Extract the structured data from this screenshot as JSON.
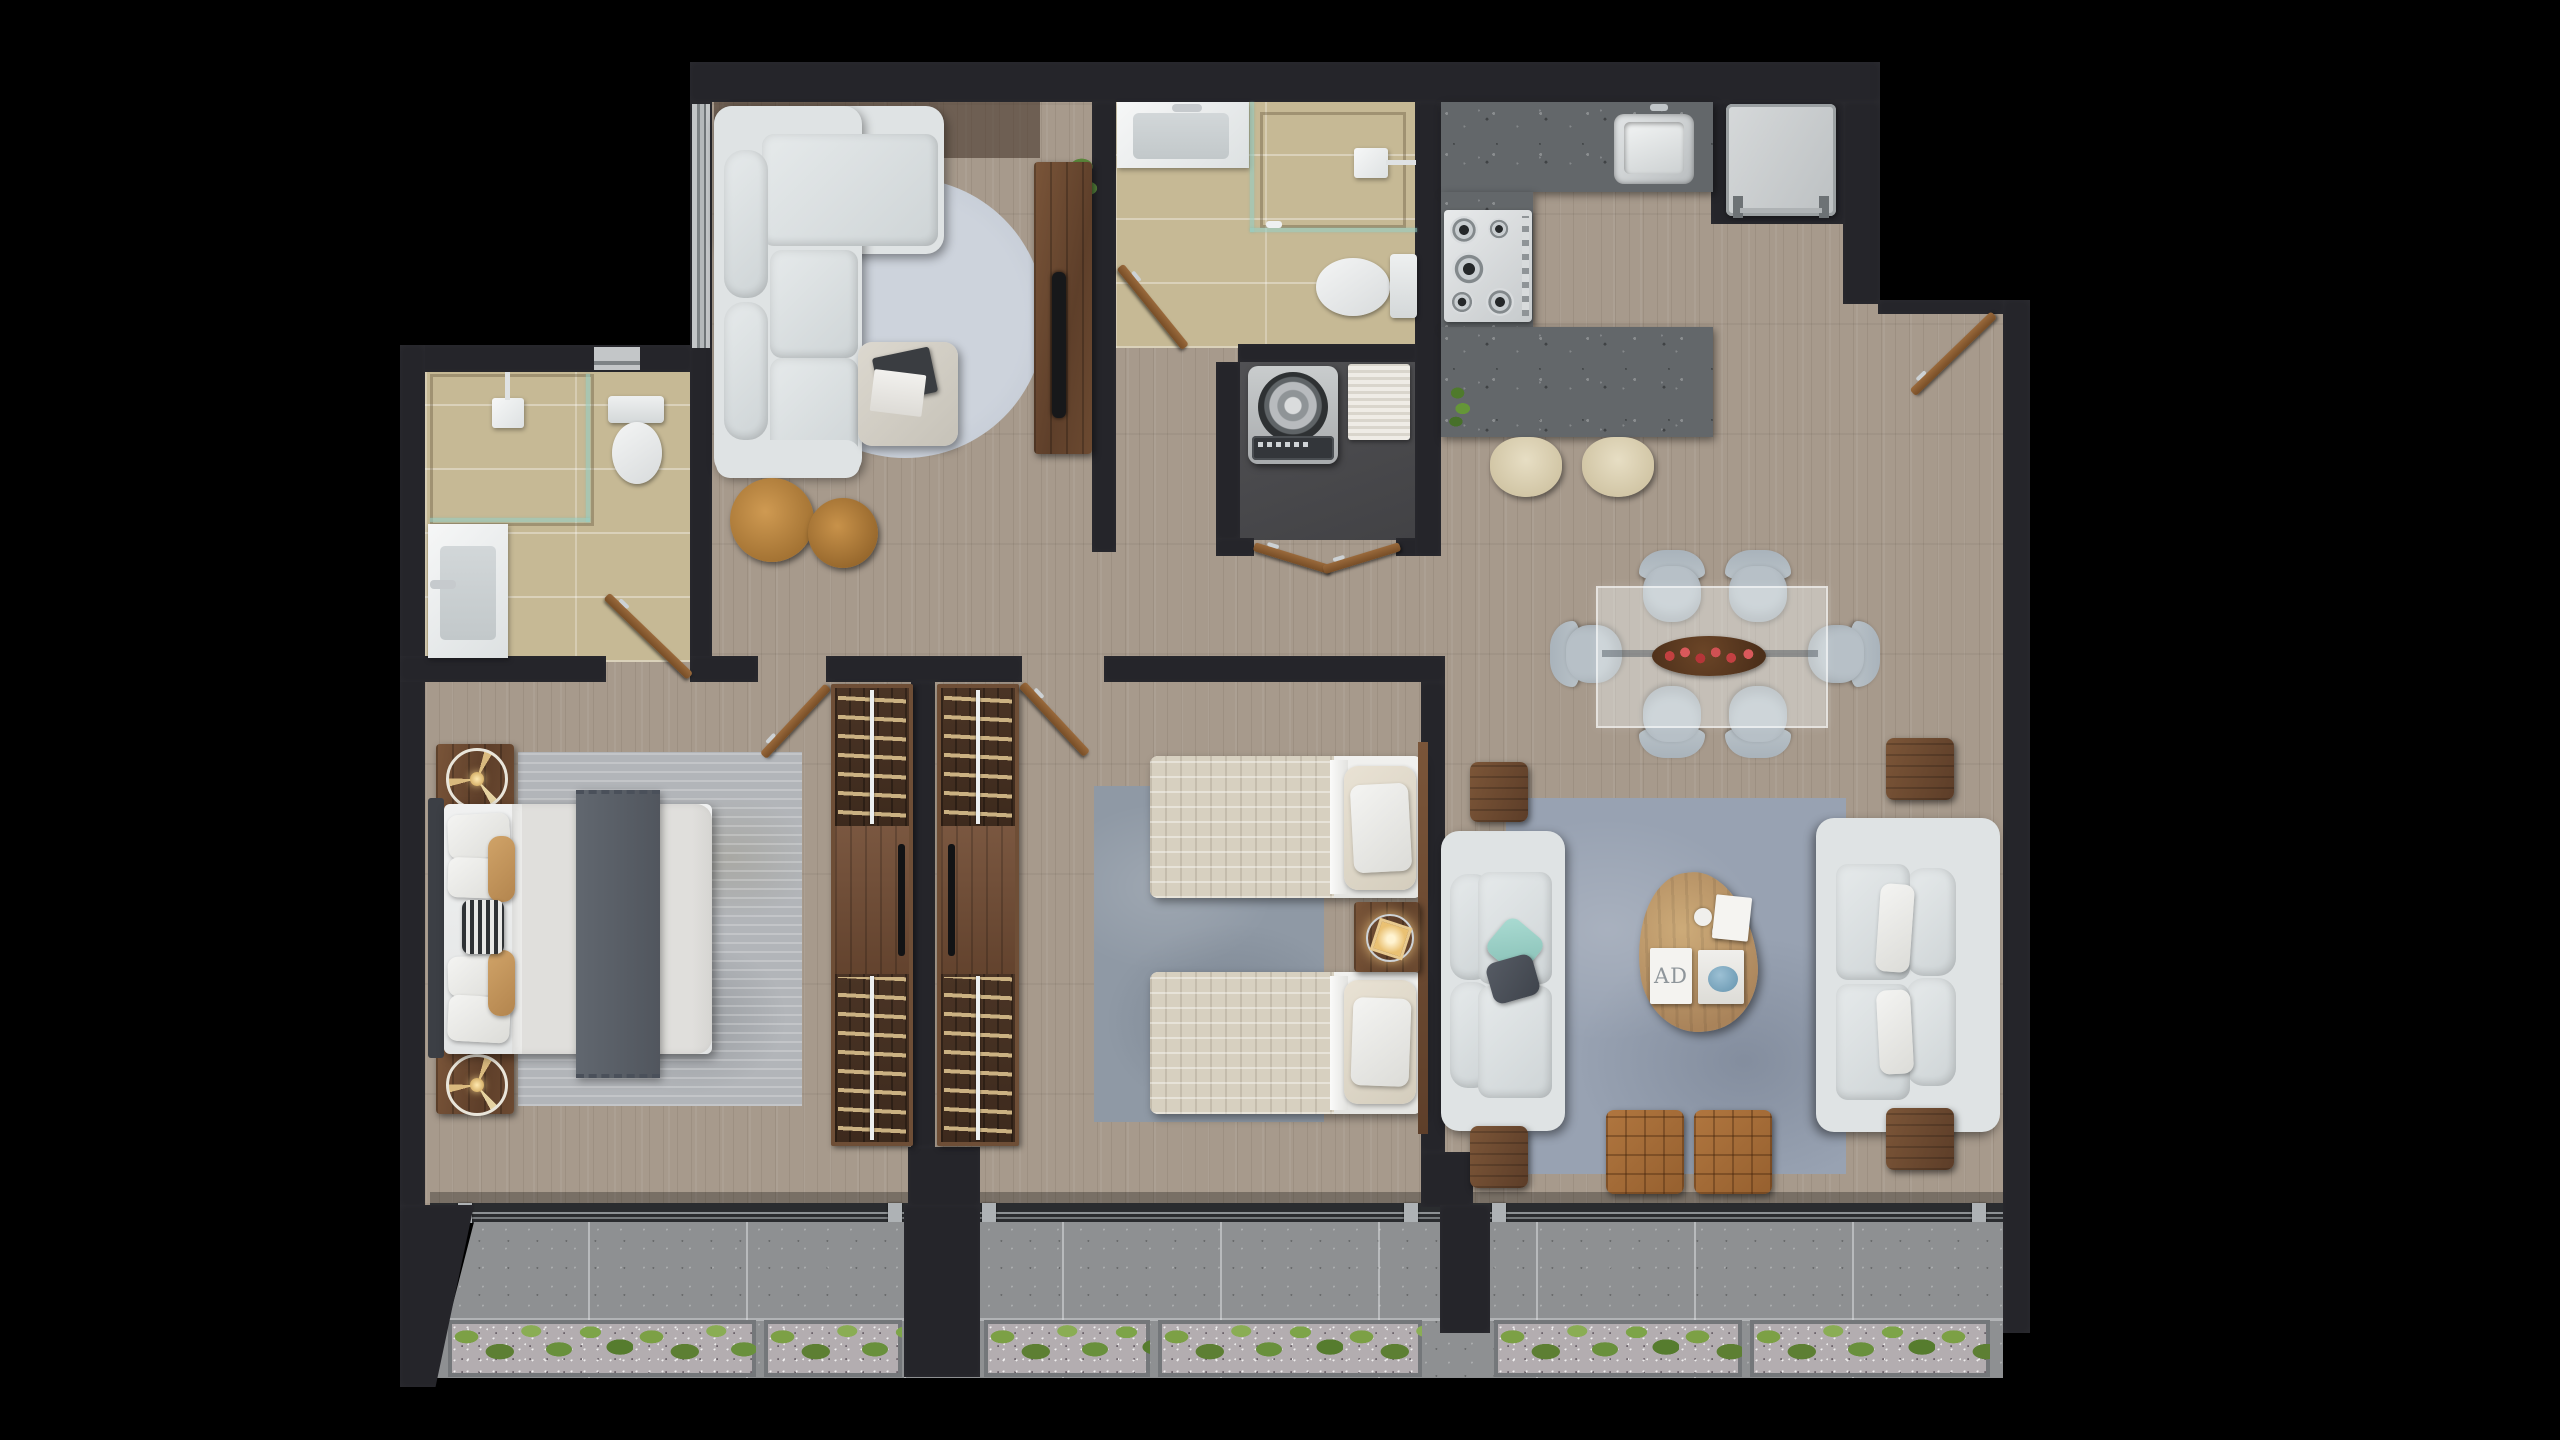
{
  "title": "Apartment floor plan — top-down 3D render",
  "colors": {
    "background": "#000000",
    "wall": "#25252a",
    "wood": "#a79a8c",
    "wood_dark": "#6b4a32",
    "tile": "#c6b995",
    "granite": "#63676a",
    "sofa": "#dfe3e4",
    "rug_round": "#c7cdd6",
    "rug_bedroom": "#b2b5b9",
    "rug_bedroom2": "#8f99a5",
    "rug_living": "#98a2b2",
    "balcony_tile": "#8e9092",
    "gravel": "#b3adb0",
    "plant": "#6b8f3d",
    "leather": "#a56b38",
    "chair": "#b7c0c7",
    "door": "#8a5c33",
    "fixture": "#f2f3f3",
    "steel": "#c9cdd0",
    "laundry_floor": "#4a4a4d",
    "quilt": "#d7d0c0",
    "throw": "#596069"
  },
  "rooms": [
    {
      "id": "family-room",
      "label": "TV lounge with sectional sofa"
    },
    {
      "id": "bathroom-main",
      "label": "Bathroom with shower, vanity and toilet"
    },
    {
      "id": "laundry",
      "label": "Laundry closet with washing machine"
    },
    {
      "id": "kitchen",
      "label": "Kitchen with island and bar stools"
    },
    {
      "id": "entry",
      "label": "Entry hall"
    },
    {
      "id": "dining",
      "label": "Dining area for six"
    },
    {
      "id": "living",
      "label": "Living room with facing sofas"
    },
    {
      "id": "bedroom-1",
      "label": "Main bedroom"
    },
    {
      "id": "closet",
      "label": "Back-to-back wardrobes"
    },
    {
      "id": "bedroom-2",
      "label": "Second bedroom with twin beds"
    },
    {
      "id": "bathroom-ensuite",
      "label": "En-suite bathroom"
    },
    {
      "id": "balcony",
      "label": "Balcony with planters"
    }
  ],
  "items": {
    "magazine_label": "AD"
  }
}
